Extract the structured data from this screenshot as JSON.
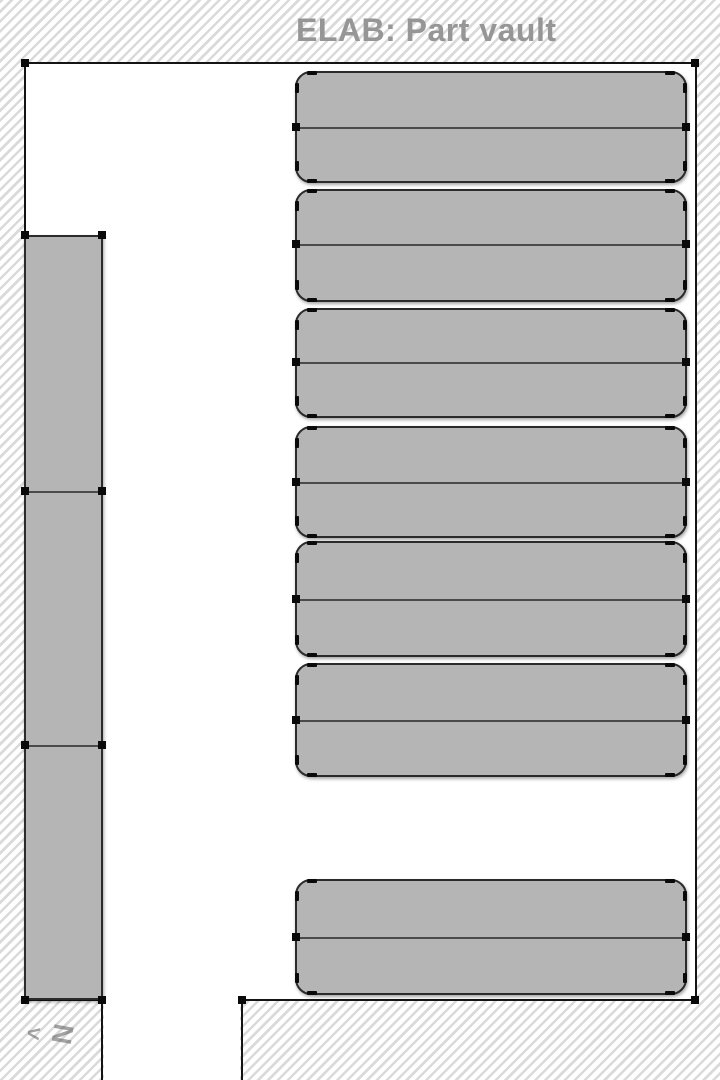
{
  "title": "ELAB: Part vault",
  "compass": {
    "letter": "N",
    "arrow": "<"
  },
  "colors": {
    "hatch_line": "#dadada",
    "background": "#ffffff",
    "room_floor": "#ffffff",
    "wall": "#141414",
    "shelf_fill": "#b5b5b5",
    "shelf_border": "#2b2b2b",
    "shelf_divider": "#4a4a4a",
    "node_marker": "#0a0a0a",
    "title_text": "#969696",
    "compass_text": "rgba(90,90,90,0.55)"
  },
  "map": {
    "room": {
      "x": 25,
      "y": 63,
      "right": 695,
      "bottom": 1000,
      "opening": {
        "x1": 102,
        "x2": 242
      },
      "corner_nodes": [
        [
          25,
          63
        ],
        [
          695,
          63
        ],
        [
          695,
          1000
        ],
        [
          242,
          1000
        ],
        [
          102,
          1000
        ],
        [
          25,
          1000
        ]
      ]
    },
    "right_shelves": [
      {
        "x": 295,
        "w": 392,
        "y": 71,
        "h": 112,
        "div": 56
      },
      {
        "x": 295,
        "w": 392,
        "y": 189,
        "h": 113,
        "div": 55
      },
      {
        "x": 295,
        "w": 392,
        "y": 308,
        "h": 110,
        "div": 54
      },
      {
        "x": 295,
        "w": 392,
        "y": 426,
        "h": 112,
        "div": 56
      },
      {
        "x": 295,
        "w": 392,
        "y": 541,
        "h": 116,
        "div": 58
      },
      {
        "x": 295,
        "w": 392,
        "y": 663,
        "h": 114,
        "div": 57
      },
      {
        "x": 295,
        "w": 392,
        "y": 879,
        "h": 116,
        "div": 58
      }
    ],
    "left_column": {
      "x": 25,
      "w": 77,
      "y": 235,
      "h": 765,
      "dividers": [
        256,
        510
      ]
    }
  }
}
